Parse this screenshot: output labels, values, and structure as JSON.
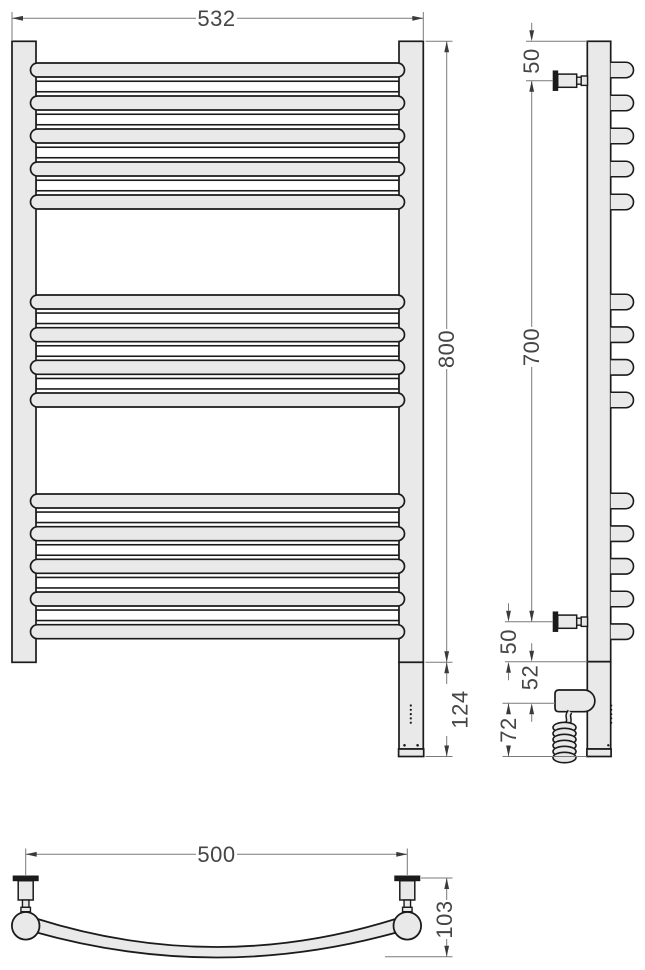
{
  "colors": {
    "background": "#ffffff",
    "part_fill": "#e9e9e9",
    "part_stroke": "#1b1b1b",
    "dark_fill": "#1b1b1b",
    "dim_line": "#7a7a7a",
    "dim_text": "#454545"
  },
  "front_view": {
    "left_post": {
      "x": 12,
      "y": 41.3,
      "w": 24,
      "h": 621
    },
    "right_post": {
      "x": 399,
      "y": 41.3,
      "w": 24.3,
      "h": 621
    },
    "housing": {
      "x": 399,
      "y": 662.3,
      "w": 24.3,
      "h": 86.7
    },
    "housing_cap": {
      "x": 398.6,
      "y": 749,
      "w": 25.1,
      "h": 7.5
    },
    "thick_bars": {
      "x": 30.5,
      "w": 374,
      "h": 14,
      "centers": [
        70,
        103,
        136,
        169,
        202,
        302,
        334.7,
        367.3,
        400,
        501,
        533.7,
        566.3,
        599,
        631.7
      ]
    },
    "thin_bars": {
      "x": 36,
      "w": 363,
      "h": 10.5,
      "centers": [
        86.5,
        119.5,
        152.5,
        185.5,
        318.3,
        351,
        383.7,
        517.3,
        550,
        582.7,
        615.3
      ]
    },
    "control_dots": {
      "x": 410.8,
      "ys": [
        705.5,
        709.8,
        714.1,
        718.4,
        722.7
      ],
      "r": 1.1
    },
    "screw_dots": [
      {
        "x": 404.5,
        "y": 745.3
      },
      {
        "x": 417.6,
        "y": 745.3
      }
    ]
  },
  "side_view": {
    "wall": {
      "x": 587.3,
      "y": 41.3,
      "w": 23.4,
      "h": 620.4
    },
    "housing": {
      "x": 587.3,
      "y": 661.7,
      "w": 23.4,
      "h": 87.3
    },
    "housing_cap": {
      "x": 586.9,
      "y": 749,
      "w": 24.2,
      "h": 7.5
    },
    "tabs": {
      "x": 610.7,
      "len": 22.8,
      "h": 15.5
    },
    "brackets": [
      {
        "axis_y": 80.7
      },
      {
        "axis_y": 621.7
      }
    ],
    "bracket_shape": {
      "flange_x": 553.2,
      "flange_w": 4.5,
      "flange_h": 19.5,
      "body_w": 19,
      "body_h": 13.2,
      "neck_w": 4.5,
      "neck_h": 7,
      "block_w": 6.3,
      "block_h": 9.4
    },
    "heater": {
      "x": 555,
      "y": 690,
      "body_w": 29,
      "h": 21.7
    },
    "coil": {
      "cx": 564.5,
      "top": 727.5,
      "loops": 6,
      "step": 6,
      "rx": 11.5,
      "ry": 5.2
    },
    "control_dots": {
      "x": 611.3,
      "ys": [
        705.5,
        709.8,
        714.1,
        718.4,
        722.7
      ],
      "r": 1.0
    },
    "screw_dots": [
      {
        "x": 608.3,
        "y": 745.3
      }
    ]
  },
  "bottom_view": {
    "brackets": [
      {
        "axis_x": 25.7
      },
      {
        "axis_x": 407.3
      }
    ],
    "bracket_shape": {
      "top_y": 876,
      "flange_w": 25,
      "flange_h": 4.7,
      "body_w": 15,
      "body_h": 19.3,
      "neck_w": 6.5,
      "neck_h": 7.3,
      "collar_w": 9.5,
      "collar_h": 4.4
    },
    "circles": {
      "cy": 925.8,
      "r": 13.8
    },
    "tube": {
      "x1": 36,
      "x2": 397,
      "top_y": 918.5,
      "bot_y": 931.5,
      "ctrl_x": 216.5,
      "ctrl_top_y": 975.5,
      "ctrl_bot_y": 983.5,
      "right_x": 400,
      "left_x": 33
    }
  },
  "dimensions": {
    "horizontal": [
      {
        "id": "overall-width",
        "label": "532",
        "y": 18.3,
        "x1": 12,
        "x2": 423.3,
        "gap": [
          196,
          237
        ],
        "text_x": 216.5,
        "text_y": 18.3,
        "ext": [
          {
            "x": 12,
            "y1": 12,
            "y2": 40
          },
          {
            "x": 423.3,
            "y1": 12,
            "y2": 40
          }
        ]
      },
      {
        "id": "bracket-span-width",
        "label": "500",
        "y": 854.3,
        "x1": 25.7,
        "x2": 407.3,
        "gap": [
          196,
          237
        ],
        "text_x": 216.5,
        "text_y": 854.3,
        "ext": [
          {
            "x": 25.7,
            "y1": 848.5,
            "y2": 875
          },
          {
            "x": 407.3,
            "y1": 848.5,
            "y2": 875
          }
        ]
      }
    ],
    "vertical": [
      {
        "id": "overall-height",
        "label": "800",
        "x": 446.7,
        "y1": 41.3,
        "y2": 662.3,
        "gap": [
          329,
          369
        ],
        "text_x": 446.7,
        "text_y": 349,
        "top": "inside",
        "bottom": "inside",
        "ext": [
          {
            "y": 41.3,
            "x1": 425.5,
            "x2": 452.5
          },
          {
            "y": 662.3,
            "x1": 425.5,
            "x2": 452.5
          }
        ]
      },
      {
        "id": "housing-height",
        "label": "124",
        "x": 446.7,
        "y1": 662.3,
        "y2": 756.5,
        "gap": [
          684,
          736
        ],
        "text_x": 460,
        "text_y": 709.5,
        "top": "inside",
        "bottom": "inside",
        "ext": [
          {
            "y": 756.5,
            "x1": 425.5,
            "x2": 452.5
          }
        ]
      },
      {
        "id": "top-bracket-offset",
        "label": "50",
        "x": 531.7,
        "y1": 41.3,
        "y2": 80.7,
        "no_line": true,
        "text_x": 531.7,
        "text_y": 61,
        "top": "outside",
        "bottom": "none",
        "ext": [
          {
            "y": 41.3,
            "x1": 526,
            "x2": 587.3
          },
          {
            "y": 80.7,
            "x1": 526,
            "x2": 553.2
          }
        ]
      },
      {
        "id": "bracket-span-height",
        "label": "700",
        "x": 531.7,
        "y1": 80.7,
        "y2": 621.7,
        "gap": [
          327,
          367
        ],
        "text_x": 531.7,
        "text_y": 347,
        "top": "inside",
        "bottom": "inside",
        "ext": []
      },
      {
        "id": "bottom-bracket-offset",
        "label": "50",
        "x": 508.5,
        "y1": 621.7,
        "y2": 661.7,
        "no_line": true,
        "text_x": 508.5,
        "text_y": 641.7,
        "top": "outside",
        "bottom": "outside",
        "ext": [
          {
            "y": 621.7,
            "x1": 505,
            "x2": 553.2
          },
          {
            "y": 661.7,
            "x1": 505,
            "x2": 587.3
          }
        ]
      },
      {
        "id": "heater-axis-offset",
        "label": "52",
        "x": 531.7,
        "y1": 661.7,
        "y2": 703.3,
        "no_line": true,
        "text_x": 530,
        "text_y": 677.5,
        "top": "outside",
        "bottom": "outside",
        "ext": [
          {
            "y": 703.3,
            "x1": 502.5,
            "x2": 555
          }
        ]
      },
      {
        "id": "heater-bottom-offset",
        "label": "72",
        "x": 508.5,
        "y1": 703.3,
        "y2": 756.5,
        "gap": [
          713,
          747
        ],
        "text_x": 508.5,
        "text_y": 730,
        "top": "inside",
        "bottom": "inside",
        "ext": [
          {
            "y": 756.5,
            "x1": 502.5,
            "x2": 586.9
          }
        ]
      },
      {
        "id": "depth",
        "label": "103",
        "x": 446.7,
        "y1": 878,
        "y2": 956.7,
        "gap": [
          900,
          939
        ],
        "text_x": 444.5,
        "text_y": 919.5,
        "top": "inside",
        "bottom": "inside",
        "ext": [
          {
            "y": 878,
            "x1": 421,
            "x2": 452.5
          },
          {
            "y": 956.7,
            "x1": 385,
            "x2": 452.5
          }
        ]
      }
    ]
  }
}
